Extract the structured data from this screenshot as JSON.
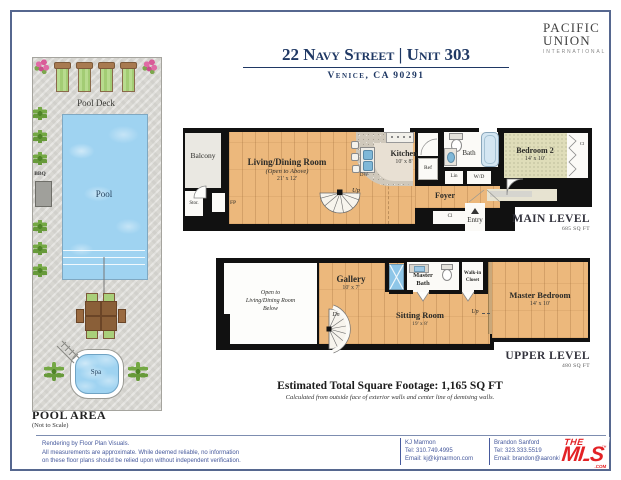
{
  "header": {
    "title": "22 Navy Street | Unit 303",
    "subtitle": "Venice, CA 90291",
    "brand_line1": "PACIFIC",
    "brand_line2": "UNION",
    "brand_line3": "INTERNATIONAL"
  },
  "pool_area": {
    "deck_label": "Pool Deck",
    "pool_label": "Pool",
    "bbq_label": "BBQ",
    "spa_label": "Spa",
    "title": "POOL AREA",
    "scale_note": "(Not to Scale)"
  },
  "main_level": {
    "balcony": "Balcony",
    "stor": "Stor.",
    "fp": "FP",
    "living_name": "Living/Dining Room",
    "living_note": "(Open to Above)",
    "living_dims": "21' x 12'",
    "stairs_up": "Up",
    "kitchen_name": "Kitchen",
    "kitchen_dims": "10' x 8'",
    "dw": "DW",
    "ref": "Ref",
    "bath": "Bath",
    "lin": "Lin",
    "wd": "W/D",
    "foyer": "Foyer",
    "closet": "Cl",
    "entry": "Entry",
    "bedroom2_name": "Bedroom 2",
    "bedroom2_dims": "14' x 10'",
    "bedroom2_closet": "Cl",
    "level_label": "MAIN LEVEL",
    "level_sqft": "685 SQ FT"
  },
  "upper_level": {
    "open_line1": "Open to",
    "open_line2": "Living/Dining Room",
    "open_line3": "Below",
    "gallery_name": "Gallery",
    "gallery_dims": "10' x 7'",
    "stairs_dn": "Dn",
    "master_bath_line1": "Master",
    "master_bath_line2": "Bath",
    "walkin_line1": "Walk-in",
    "walkin_line2": "Closet",
    "sitting_name": "Sitting Room",
    "sitting_dims": "19' x 8'",
    "step_up": "Up",
    "master_bedroom_name": "Master Bedroom",
    "master_bedroom_dims": "14' x 10'",
    "level_label": "UPPER LEVEL",
    "level_sqft": "480 SQ FT"
  },
  "totals": {
    "line1": "Estimated Total Square Footage: 1,165 SQ FT",
    "line2": "Calculated from outside face of exterior walls and center line of demising walls."
  },
  "footer": {
    "disclaimer_line1": "Rendering by Floor Plan Visuals.",
    "disclaimer_line2": "All measurements are approximate. While deemed reliable, no information",
    "disclaimer_line3": "on these floor plans should be relied upon without independent verification.",
    "agent1_name": "KJ Marmon",
    "agent1_tel": "Tel: 310.749.4995",
    "agent1_email": "Email: kj@kjmarmon.com",
    "agent2_name": "Brandon Sanford",
    "agent2_tel": "Tel: 323.333.5519",
    "agent2_email": "Email: brandon@aaronkirman.com",
    "mls_the": "THE",
    "mls_mls": "MLS",
    "mls_tm": "™",
    "mls_com": ".COM"
  },
  "colors": {
    "accent_navy": "#1f3864",
    "wall_black": "#111111",
    "wood": "#ecb87c",
    "carpet": "#dfddb9",
    "pool_blue": "#9fd3f1",
    "deck_gray": "#d8d7d2",
    "footer_blue": "#46599c",
    "mls_red": "#e32226"
  }
}
